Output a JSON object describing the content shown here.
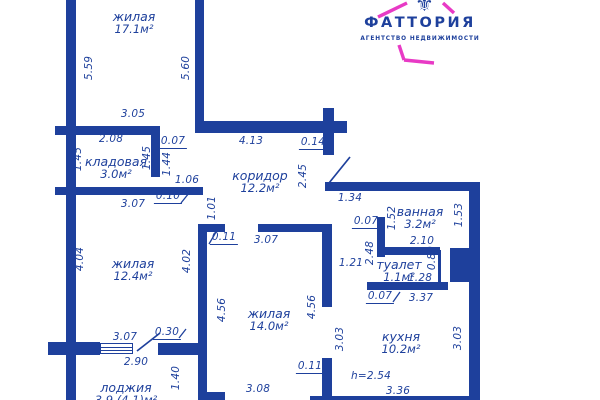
{
  "logo": {
    "brand": "ФАТТОРИЯ",
    "tagline": "АГЕНТСТВО НЕДВИЖИМОСТИ",
    "emblem_icon": "fleur-ornament-icon",
    "brand_color": "#1d3c98",
    "accent_color": "#e83ac5"
  },
  "floorplan": {
    "ink_color": "#1e409c",
    "ceiling_height_note": "h=2.54",
    "rooms": [
      {
        "name": "жилая",
        "area": "17.1м²",
        "cx": 134,
        "cy": 23
      },
      {
        "name": "кладовая",
        "area": "3.0м²",
        "cx": 116,
        "cy": 168
      },
      {
        "name": "коридор",
        "area": "12.2м²",
        "cx": 260,
        "cy": 182
      },
      {
        "name": "жилая",
        "area": "12.4м²",
        "cx": 133,
        "cy": 270
      },
      {
        "name": "жилая",
        "area": "14.0м²",
        "cx": 269,
        "cy": 320
      },
      {
        "name": "ванная",
        "area": "3.2м²",
        "cx": 420,
        "cy": 218
      },
      {
        "name": "туалет",
        "area": "1.1м²",
        "cx": 399,
        "cy": 271
      },
      {
        "name": "кухня",
        "area": "10.2м²",
        "cx": 401,
        "cy": 343
      },
      {
        "name": "лоджия",
        "area": "3.9 (4.1)м²",
        "cx": 126,
        "cy": 394
      }
    ],
    "dimensions": [
      {
        "v": "5.59",
        "cx": 89,
        "cy": 68,
        "rot": 1
      },
      {
        "v": "5.60",
        "cx": 186,
        "cy": 68,
        "rot": 1
      },
      {
        "v": "3.05",
        "cx": 133,
        "cy": 114
      },
      {
        "v": "2.08",
        "cx": 111,
        "cy": 139
      },
      {
        "v": "0.07",
        "cx": 173,
        "cy": 142,
        "u": 1
      },
      {
        "v": "1.45",
        "cx": 78,
        "cy": 159,
        "rot": 1
      },
      {
        "v": "1.45",
        "cx": 147,
        "cy": 158,
        "rot": 1
      },
      {
        "v": "1.44",
        "cx": 167,
        "cy": 164,
        "rot": 1
      },
      {
        "v": "1.06",
        "cx": 187,
        "cy": 180
      },
      {
        "v": "0.10",
        "cx": 168,
        "cy": 197,
        "u": 1
      },
      {
        "v": "3.07",
        "cx": 133,
        "cy": 204
      },
      {
        "v": "1.01",
        "cx": 212,
        "cy": 208,
        "rot": 1
      },
      {
        "v": "4.13",
        "cx": 251,
        "cy": 141
      },
      {
        "v": "0.14",
        "cx": 313,
        "cy": 143,
        "u": 1
      },
      {
        "v": "2.45",
        "cx": 303,
        "cy": 176,
        "rot": 1
      },
      {
        "v": "1.34",
        "cx": 350,
        "cy": 198
      },
      {
        "v": "0.07",
        "cx": 366,
        "cy": 222,
        "u": 1
      },
      {
        "v": "1.52",
        "cx": 392,
        "cy": 218,
        "rot": 1
      },
      {
        "v": "1.53",
        "cx": 459,
        "cy": 215,
        "rot": 1
      },
      {
        "v": "2.10",
        "cx": 422,
        "cy": 241
      },
      {
        "v": "2.48",
        "cx": 370,
        "cy": 253,
        "rot": 1
      },
      {
        "v": "1.21",
        "cx": 351,
        "cy": 263
      },
      {
        "v": "0.89",
        "cx": 432,
        "cy": 258,
        "rot": 1
      },
      {
        "v": "1.28",
        "cx": 420,
        "cy": 278
      },
      {
        "v": "0.07",
        "cx": 380,
        "cy": 297,
        "u": 1
      },
      {
        "v": "3.37",
        "cx": 421,
        "cy": 298
      },
      {
        "v": "0.11",
        "cx": 224,
        "cy": 238,
        "u": 1
      },
      {
        "v": "3.07",
        "cx": 266,
        "cy": 240
      },
      {
        "v": "4.56",
        "cx": 222,
        "cy": 310,
        "rot": 1
      },
      {
        "v": "4.56",
        "cx": 312,
        "cy": 307,
        "rot": 1
      },
      {
        "v": "3.03",
        "cx": 340,
        "cy": 339,
        "rot": 1
      },
      {
        "v": "3.03",
        "cx": 458,
        "cy": 338,
        "rot": 1
      },
      {
        "v": "0.11",
        "cx": 310,
        "cy": 367,
        "u": 1
      },
      {
        "v": "h=2.54",
        "cx": 371,
        "cy": 376
      },
      {
        "v": "3.36",
        "cx": 398,
        "cy": 391
      },
      {
        "v": "3.08",
        "cx": 258,
        "cy": 389
      },
      {
        "v": "4.04",
        "cx": 80,
        "cy": 259,
        "rot": 1
      },
      {
        "v": "4.02",
        "cx": 187,
        "cy": 261,
        "rot": 1
      },
      {
        "v": "3.07",
        "cx": 125,
        "cy": 337
      },
      {
        "v": "0.30",
        "cx": 167,
        "cy": 333,
        "u": 1
      },
      {
        "v": "2.90",
        "cx": 136,
        "cy": 362
      },
      {
        "v": "1.40",
        "cx": 176,
        "cy": 378,
        "rot": 1
      }
    ],
    "walls": [
      [
        66,
        0,
        10,
        400
      ],
      [
        195,
        0,
        9,
        133
      ],
      [
        55,
        126,
        105,
        9
      ],
      [
        151,
        126,
        9,
        51
      ],
      [
        55,
        187,
        148,
        8
      ],
      [
        198,
        121,
        149,
        12
      ],
      [
        323,
        108,
        11,
        47
      ],
      [
        325,
        182,
        155,
        9
      ],
      [
        469,
        182,
        11,
        218
      ],
      [
        377,
        217,
        8,
        40
      ],
      [
        385,
        247,
        55,
        8
      ],
      [
        438,
        250,
        3,
        32
      ],
      [
        450,
        248,
        25,
        34
      ],
      [
        367,
        282,
        81,
        8
      ],
      [
        198,
        224,
        9,
        176
      ],
      [
        198,
        224,
        27,
        8
      ],
      [
        258,
        224,
        72,
        8
      ],
      [
        322,
        224,
        10,
        83
      ],
      [
        322,
        358,
        10,
        42
      ],
      [
        48,
        342,
        52,
        13
      ],
      [
        158,
        343,
        42,
        12
      ],
      [
        198,
        392,
        27,
        8
      ],
      [
        310,
        396,
        170,
        4
      ]
    ],
    "window": {
      "x": 100,
      "y": 343,
      "w": 33,
      "h": 11
    },
    "door_lines": [
      [
        329,
        183,
        350,
        157
      ],
      [
        137,
        351,
        160,
        333
      ]
    ],
    "leader_ticks": [
      [
        181,
        203,
        189,
        193
      ],
      [
        209,
        244,
        216,
        232
      ],
      [
        324,
        149,
        330,
        140
      ],
      [
        179,
        338,
        186,
        329
      ],
      [
        393,
        302,
        400,
        292
      ]
    ],
    "logo_frame_lines": [
      [
        378,
        17,
        407,
        3
      ],
      [
        443,
        3,
        454,
        13
      ],
      [
        399,
        45,
        404,
        60
      ],
      [
        404,
        60,
        434,
        63
      ]
    ]
  }
}
